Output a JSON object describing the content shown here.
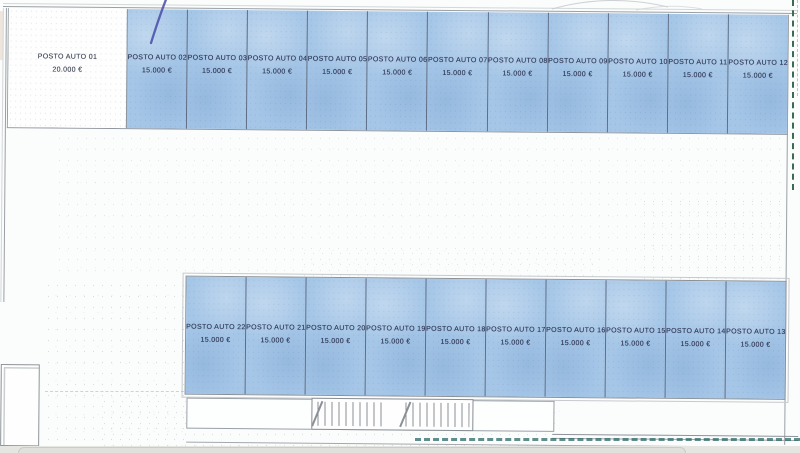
{
  "colors": {
    "highlight_blue": "#a5c6e7",
    "divider_blue": "#5e6d85",
    "line_gray": "#9aa0a4",
    "ink": "#2b3250",
    "pen_blue": "#4b50a8",
    "dash_green": "#3c6b52",
    "dash_teal": "#2d6a68",
    "band_gray": "#e5e5e2"
  },
  "top_row": {
    "spots": [
      {
        "label": "POSTO AUTO 01",
        "price": "20.000 €",
        "highlighted": false
      },
      {
        "label": "POSTO AUTO 02",
        "price": "15.000 €",
        "highlighted": true
      },
      {
        "label": "POSTO AUTO 03",
        "price": "15.000 €",
        "highlighted": true
      },
      {
        "label": "POSTO AUTO 04",
        "price": "15.000 €",
        "highlighted": true
      },
      {
        "label": "POSTO AUTO 05",
        "price": "15.000 €",
        "highlighted": true
      },
      {
        "label": "POSTO AUTO 06",
        "price": "15.000 €",
        "highlighted": true
      },
      {
        "label": "POSTO AUTO 07",
        "price": "15.000 €",
        "highlighted": true
      },
      {
        "label": "POSTO AUTO 08",
        "price": "15.000 €",
        "highlighted": true
      },
      {
        "label": "POSTO AUTO 09",
        "price": "15.000 €",
        "highlighted": true
      },
      {
        "label": "POSTO AUTO 10",
        "price": "15.000 €",
        "highlighted": true
      },
      {
        "label": "POSTO AUTO 11",
        "price": "15.000 €",
        "highlighted": true
      },
      {
        "label": "POSTO AUTO 12",
        "price": "15.000 €",
        "highlighted": true
      }
    ]
  },
  "bottom_row": {
    "spots": [
      {
        "label": "POSTO AUTO 22",
        "price": "15.000 €",
        "highlighted": true
      },
      {
        "label": "POSTO AUTO 21",
        "price": "15.000 €",
        "highlighted": true
      },
      {
        "label": "POSTO AUTO 20",
        "price": "15.000 €",
        "highlighted": true
      },
      {
        "label": "POSTO AUTO 19",
        "price": "15.000 €",
        "highlighted": true
      },
      {
        "label": "POSTO AUTO 18",
        "price": "15.000 €",
        "highlighted": true
      },
      {
        "label": "POSTO AUTO 17",
        "price": "15.000 €",
        "highlighted": true
      },
      {
        "label": "POSTO AUTO 16",
        "price": "15.000 €",
        "highlighted": true
      },
      {
        "label": "POSTO AUTO 15",
        "price": "15.000 €",
        "highlighted": true
      },
      {
        "label": "POSTO AUTO 14",
        "price": "15.000 €",
        "highlighted": true
      },
      {
        "label": "POSTO AUTO 13",
        "price": "15.000 €",
        "highlighted": true
      }
    ]
  }
}
